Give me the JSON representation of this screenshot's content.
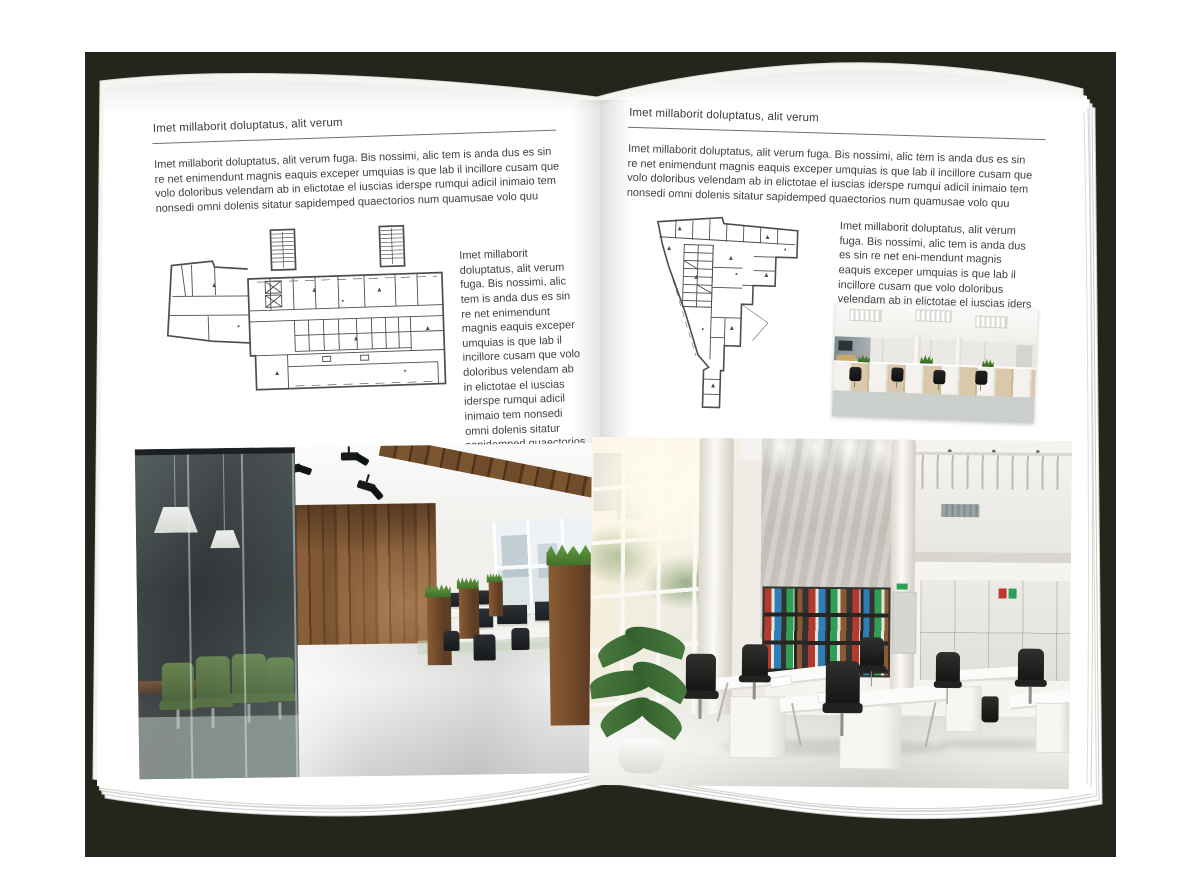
{
  "scene": {
    "backdrop_color": "#23261b",
    "paper_color": "#ffffff"
  },
  "left_page": {
    "header": "Imet millaborit doluptatus, alit verum",
    "intro": "Imet millaborit doluptatus, alit verum fuga. Bis nossimi, alic tem is anda dus es sin re net enimendunt magnis eaquis exceper umquias is que lab il incillore cusam que volo doloribus velendam ab in elictotae el iuscias iderspe rumqui adicil inimaio tem nonsedi omni dolenis sitatur sapidemped quaectorios num quamusae volo quu",
    "sidebar": "Imet millaborit doluptatus, alit verum fuga. Bis nossimi, alic tem is anda dus es sin re net enimendunt magnis eaquis exceper umquias is que lab il incillore cusam que volo doloribus velendam ab in elictotae el iuscias iderspe rumqui adicil inimaio tem nonsedi omni dolenis sitatur sapidemped quaectorios num quamusae volo quu"
  },
  "right_page": {
    "header": "Imet millaborit doluptatus, alit verum",
    "intro": "Imet millaborit doluptatus, alit verum fuga. Bis nossimi, alic tem is anda dus es sin re net enimendunt magnis eaquis exceper umquias is que lab il incillore cusam que volo doloribus velendam ab in elictotae el iuscias iderspe rumqui adicil inimaio tem nonsedi omni dolenis sitatur sapidemped quaectorios num quamusae volo quu",
    "sidebar": "Imet millaborit doluptatus, alit verum fuga. Bis nossimi, alic tem is anda dus es sin re net eni-mendunt magnis eaquis exceper umquias is que lab il incillore cusam que volo doloribus velendam ab in elictotae el iuscias iders"
  },
  "media": {
    "left_floor_plan": "floor-plan-line-drawing",
    "right_floor_plan": "floor-plan-line-drawing",
    "left_photo": "dark-wood-and-glass-office-interior-photo",
    "right_photo": "bright-atrium-office-interior-photo",
    "small_photo": "open-plan-workstations-photo"
  },
  "palette": {
    "backdrop": "#23261b",
    "text": "#404040",
    "plan_line": "#4d4d4d",
    "wood": "#7a5332",
    "plant_green": "#4a7c3f",
    "binder_red": "#b23b2e",
    "binder_green": "#2f9e57",
    "binder_blue": "#2d7fb8"
  }
}
